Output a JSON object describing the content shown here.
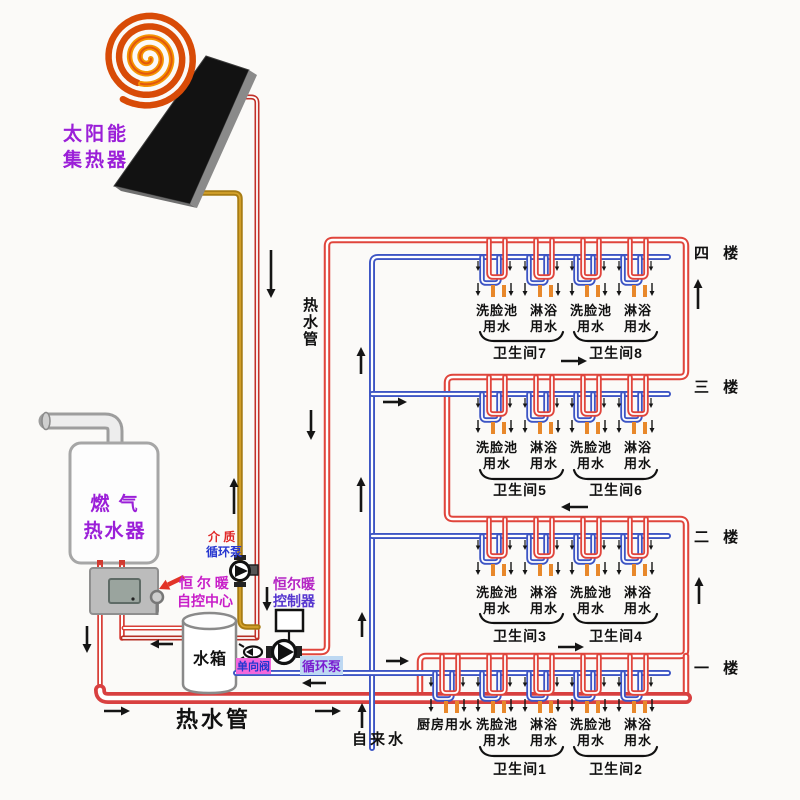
{
  "colors": {
    "pipe_red": "#e0453c",
    "pipe_red_dark": "#b52f24",
    "pipe_blue": "#3d55c4",
    "pipe_gold": "#a87c14",
    "faucet_orange": "#e8882b",
    "solar_label_purple": "#9b1fd8",
    "heater_label_purple": "#9b1fd8",
    "control_center_magenta": "#c81ec8",
    "controller_line1": "#b424c4",
    "controller_line2": "#5636cf",
    "medium_line1_red": "#e02828",
    "medium_line2_blue": "#2838d0",
    "check_valve_text": "#2336d0",
    "check_valve_bg": "#f468dc",
    "circ_pump_text": "#7a1fd0",
    "circ_pump_bg": "#bdd8f2",
    "panel_black": "#121212",
    "spiral_outer": "#d84b07",
    "spiral_inner": "#f59300"
  },
  "labels": {
    "solar_collector_1": "太阳能",
    "solar_collector_2": "集热器",
    "gas_heater_1": "燃 气",
    "gas_heater_2": "热水器",
    "control_center_1": "恒 尔 暖",
    "control_center_2": "自控中心",
    "medium_pump_1": "介 质",
    "medium_pump_2": "循环泵",
    "controller_1": "恒尔暖",
    "controller_2": "控制器",
    "water_tank": "水箱",
    "check_valve": "单向阀",
    "circulation_pump": "循环泵",
    "hot_water_pipe_riser": "热水管",
    "hot_water_pipe_bottom": "热水管",
    "tap_water": "自来水"
  },
  "floors": [
    {
      "name": "四 楼",
      "fixtures": [
        "洗脸池用水",
        "淋浴用水",
        "洗脸池用水",
        "淋浴用水"
      ],
      "bathrooms": [
        "卫生间7",
        "卫生间8"
      ]
    },
    {
      "name": "三 楼",
      "fixtures": [
        "洗脸池用水",
        "淋浴用水",
        "洗脸池用水",
        "淋浴用水"
      ],
      "bathrooms": [
        "卫生间5",
        "卫生间6"
      ]
    },
    {
      "name": "二 楼",
      "fixtures": [
        "洗脸池用水",
        "淋浴用水",
        "洗脸池用水",
        "淋浴用水"
      ],
      "bathrooms": [
        "卫生间3",
        "卫生间4"
      ]
    },
    {
      "name": "一 楼",
      "fixtures": [
        "厨房用水",
        "洗脸池用水",
        "淋浴用水",
        "洗脸池用水",
        "淋浴用水"
      ],
      "bathrooms": [
        "卫生间1",
        "卫生间2"
      ]
    }
  ]
}
